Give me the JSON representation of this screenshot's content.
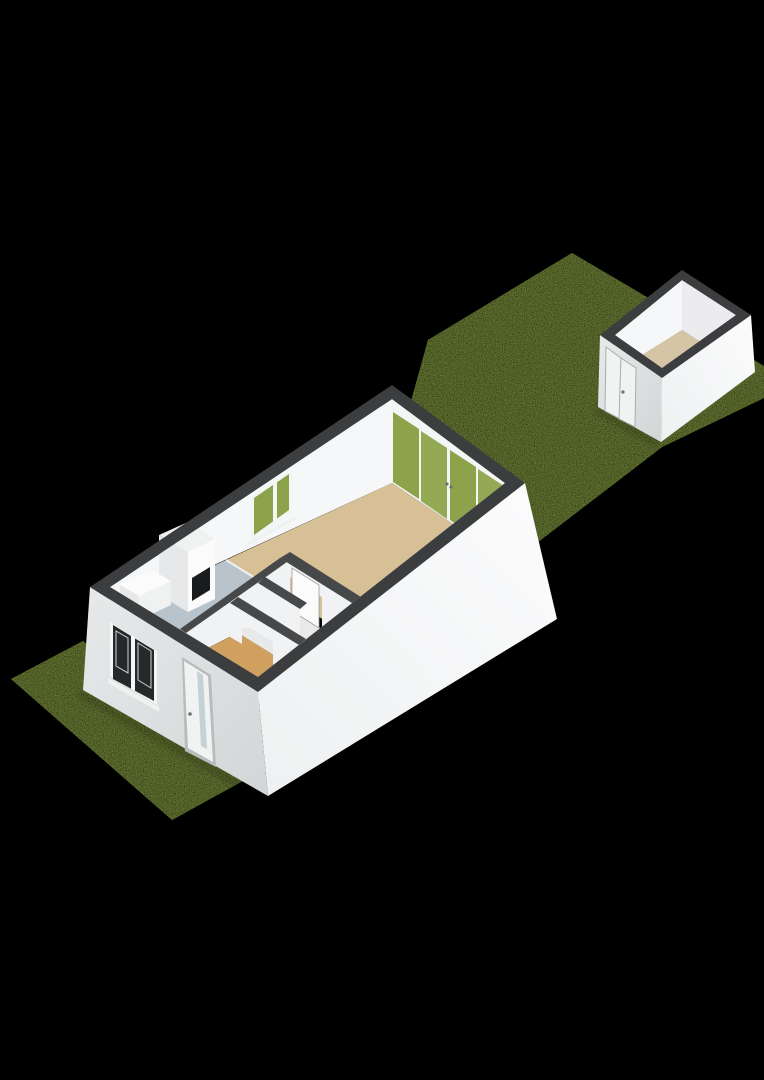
{
  "scene": {
    "description": "3D dollhouse-style floor plan render of a small single-storey home on a long lawn parcel with a detached shed at the rear",
    "view": "elevated oblique view from the front-left",
    "background_color": "#000000"
  },
  "colors": {
    "background": "#000000",
    "grass": "#8ba348",
    "wallTop": "#3c3d3e",
    "wallTopInner": "#47484a",
    "extBright1": "#fcfcfd",
    "extBright2": "#eef0f1",
    "extShade1": "#e7e9ea",
    "extShade2": "#d3d5d7",
    "intBright": "#f6f7f8",
    "intShade": "#ececee",
    "partitionFace": "#f1f2f3",
    "floorLiving": "#d8c096",
    "floorKitchen": "#b9c3cb",
    "floorHall": "#cfa05e",
    "floorBath": "#e9eae7",
    "floorShed": "#d5c5a5",
    "glassGreen": "#8ca24b",
    "glassGreen2": "#93a954",
    "glassDark": "#26282a",
    "frame": "#f4f5f5",
    "leaf": "#f1f2f2",
    "doorGlass": "#c5d1d4",
    "fixture": "#fbfbfb",
    "fixtureShade": "#e7e8e9",
    "fixtureSide": "#f0f1f1",
    "niche": "#1a1b1d",
    "handle": "#6f7273",
    "divider": "#eef1f3",
    "sill": "#f0f1f1",
    "shadow": "#000000"
  },
  "parcel": {
    "front_garden": "lawn",
    "back_garden": "lawn"
  },
  "house": {
    "rooms": [
      {
        "name": "living-room",
        "floor": "light tan"
      },
      {
        "name": "kitchen",
        "floor": "blue-grey",
        "fixtures": [
          "tall cabinet with dark appliance niche",
          "counter"
        ]
      },
      {
        "name": "hall",
        "floor": "orange tan",
        "fixtures": [
          "front door"
        ]
      },
      {
        "name": "wc",
        "floor": "off-white",
        "fixtures": [
          "toilet"
        ]
      },
      {
        "name": "bathroom",
        "floor": "off-white",
        "fixtures": [
          "interior door"
        ]
      }
    ],
    "openings": [
      "front window (dark glass)",
      "front door with glazing strip",
      "side window (garden view)",
      "rear glass wall with 4 door panels"
    ]
  },
  "shed": {
    "rooms": [
      {
        "name": "storage",
        "floor": "beige"
      }
    ],
    "openings": [
      "double door facing garden"
    ]
  }
}
